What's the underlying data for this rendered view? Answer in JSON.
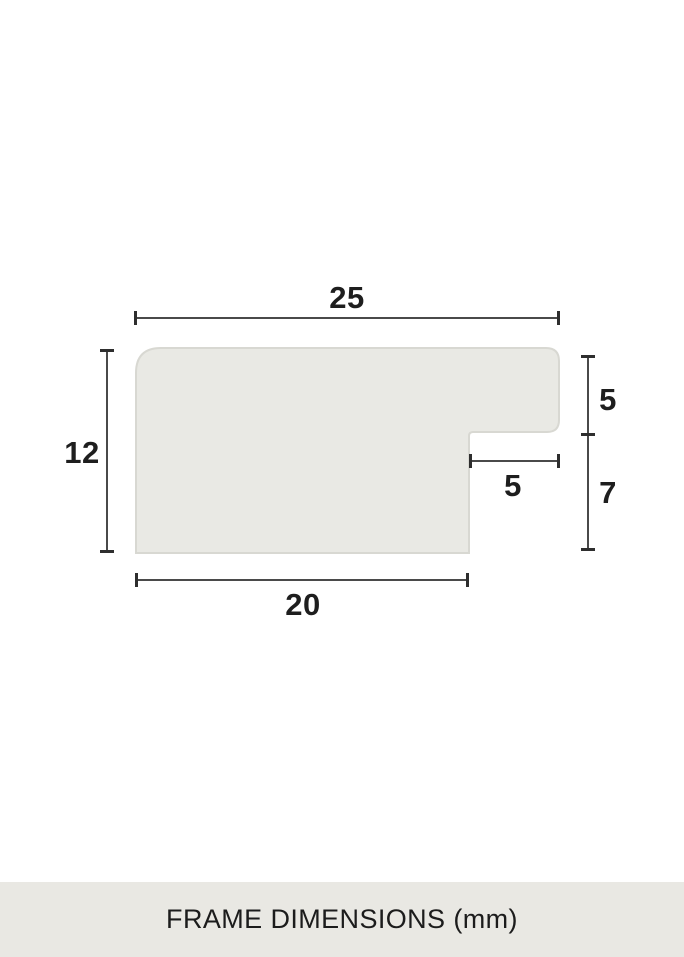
{
  "diagram": {
    "caption": "FRAME DIMENSIONS (mm)",
    "unit": "mm",
    "dimensions": {
      "top_width": "25",
      "left_height": "12",
      "right_upper_height": "5",
      "rabbet_width": "5",
      "right_lower_height": "7",
      "bottom_width": "20"
    },
    "colors": {
      "background": "#ffffff",
      "profile_fill": "#e9e9e4",
      "profile_border": "#d8d8d2",
      "dimension_line": "#4a4a4a",
      "text": "#1e1e1e",
      "caption_bar_background": "#e9e8e3"
    }
  }
}
